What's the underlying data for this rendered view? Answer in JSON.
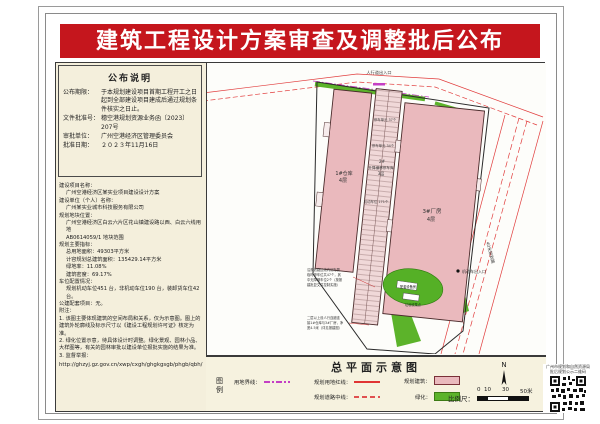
{
  "title": "建筑工程设计方案审查及调整批后公布",
  "colors": {
    "title_bg": "#c5161d",
    "panel_bg": "#f4efdc",
    "building_pink": "#eab9bd",
    "green": "#5cb32a",
    "road_red": "#e13c3c",
    "boundary_magenta": "#c43fc4"
  },
  "notice": {
    "heading": "公布说明",
    "items": [
      {
        "label": "公布期限：",
        "value": "于本规划建设项目首期工程开工之日起到全部建设项目建成后通过规划条件核实之日止。"
      },
      {
        "label": "文件批准号：",
        "value": "穗空港规划资源业务函〔2023〕207号"
      },
      {
        "label": "审批单位：",
        "value": "广州空港经济区管理委员会"
      },
      {
        "label": "批准日期：",
        "value": "２０２３年11月16日"
      }
    ]
  },
  "info": {
    "name_label": "建设项目名称：",
    "name_value": "广州空港经济区某实业项目建设设计方案",
    "unit_label": "建设单位（个人）名称：",
    "unit_value": "广州某实业城市科技服务有限公司",
    "location_label": "规划地块位置：",
    "location_value1": "广州空港经济区白云六片区花山镇建设路以西、白云六线用地",
    "location_value2": "AB0614059/1 地块范围",
    "indicators_label": "规划主要指标：",
    "ind1": "总用地面积：49303平方米",
    "ind2": "计容规划总建筑面积：135429.14平方米",
    "ind3": "绿地率：11.08%",
    "ind4": "建筑密度：69.17%",
    "parking_label": "车位配置情况：",
    "parking_value": "规划机动车位451 台，非机动车位190 台，装卸货车位42 台。",
    "public_label": "公建配套项目：无。",
    "notes_label": "附注：",
    "note1": "1. 该图主要体现建筑的空间布局和关系，仅为示意图。图上的建筑外轮廓线及标示尺寸以《建设工程规划许可证》核定为准。",
    "note2": "2. 绿化位置示意，待具体设计时调整。绿化景观、园林小品、大样图等，有关的园林审批以建设单位报批实施的结果为准。",
    "note3": "3. 监督举报：",
    "url": "http://ghzyj.gz.gov.cn/xwp/cxgh/ghgkgsgb/phgb/qbh/"
  },
  "map": {
    "pedestrian_entrance": "人行道出入口",
    "b1_name": "1#仓库",
    "b1_floors": "4层",
    "b2_no": "2#",
    "b2_name": "升降横移停车库",
    "b2_floors": "3层",
    "parking1": "停车单元 37个",
    "parking2": "停车单元 34个",
    "parking3": "机动车位 171个",
    "b3_name": "3#厂房",
    "b3_floors": "4层",
    "vehicle_entrance": "机动车出入口",
    "road_label": "40米规划路",
    "facility1": "配套设备房",
    "facility2": "垃圾收集点",
    "noteA1": "沿规划路边线内侧布置",
    "noteA2": "临时停车位共47个，其",
    "noteA3": "中无障碍车位2个（按报",
    "noteA4": "建批复文件控制实施）",
    "noteB1": "二层以上设人行连廊连",
    "noteB2": "接1#仓库与3#厂房，净",
    "noteB3": "宽4.5米（详见报建图）"
  },
  "legend": {
    "title": "总平面示意图",
    "key1": "图",
    "key2": "例",
    "item_boundary": "用地界线：",
    "item_redline": "规划用地红线：",
    "item_roadcenter": "规划道路中线：",
    "item_building": "规划建筑：",
    "item_green": "绿化：",
    "north": "N",
    "scale_label": "比例尺：",
    "tick0": "0",
    "tick1": "10",
    "tick2": "30",
    "tick3": "50米"
  },
  "qr": {
    "caption1": "广州市规划和自然资源局",
    "caption2": "批后规划公示二维码"
  }
}
